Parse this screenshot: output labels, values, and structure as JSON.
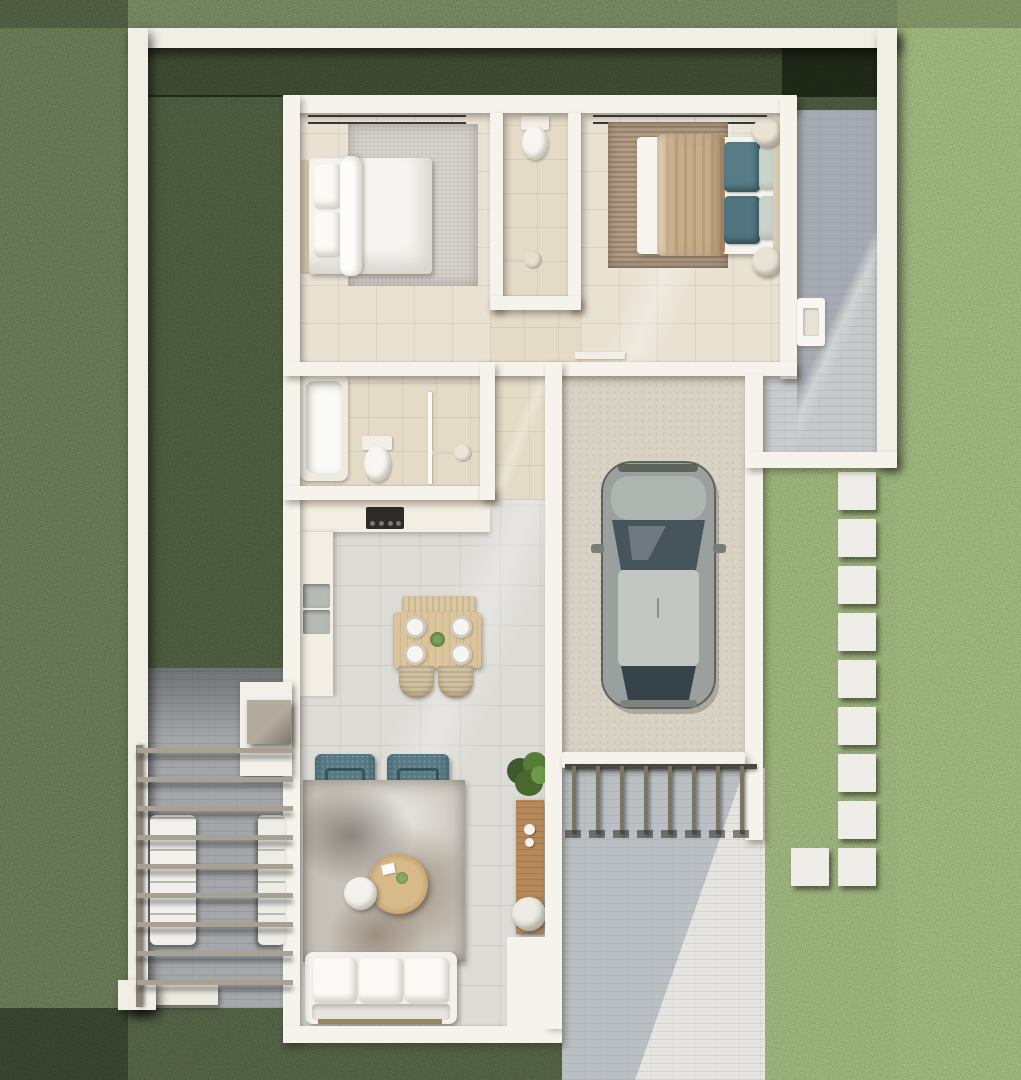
{
  "meta": {
    "view": "top-down-3d-render",
    "subject": "single-story residential floor plan with yard, garage, pergola patio and stepping-stone path"
  },
  "palette": {
    "grass_base": "#49662f",
    "wall_white": "#f6f3ec",
    "warm_tile": "#e9e2d3",
    "gray_tile": "#dcdbd6",
    "garage_floor": "#d8d2c4",
    "paver_gray": "#c6c8ca",
    "patio_paver": "#b4b8bb",
    "walkway": "#e5e4e0",
    "wood": "#c9a06c",
    "teal_accent": "#577a85",
    "tan_duvet": "#c7ad8c",
    "car_body": "#9aa09e",
    "car_roof": "#c3c7c2",
    "car_glass": "#46545b",
    "car_rear_glass": "#37434a",
    "plant_green": "#4c7034"
  },
  "counts": {
    "stepping_stones_column": 9,
    "stepping_stone_offset": 1,
    "pergola_beams": 9,
    "railing_posts": 8,
    "sofa_cushions": 3,
    "dining_plates": 4,
    "dining_chairs": 2,
    "living_armchairs": 2
  },
  "rooms": [
    {
      "id": "bedroom-1",
      "furniture": [
        "double-bed",
        "four-pillows",
        "white-throw",
        "nightstand-lamp-top",
        "nightstand-lamp-bottom",
        "gray-area-rug",
        "white-dresser",
        "curtain-rail"
      ]
    },
    {
      "id": "shared-bathroom",
      "furniture": [
        "toilet",
        "vanity-sink",
        "shower-head"
      ]
    },
    {
      "id": "bedroom-2",
      "furniture": [
        "double-bed",
        "tan-duvet",
        "teal-pillows",
        "striped-rug",
        "round-pouf-top",
        "round-pouf-bottom",
        "white-dresser",
        "wall-shelf",
        "curtain-rail"
      ]
    },
    {
      "id": "main-bathroom",
      "furniture": [
        "bathtub",
        "vanity-sink",
        "toilet",
        "glass-shower"
      ]
    },
    {
      "id": "hallway",
      "furniture": []
    },
    {
      "id": "kitchen-dining",
      "furniture": [
        "counter-run-top",
        "cooktop",
        "counter-run-left",
        "double-sink",
        "dining-bench",
        "dining-table",
        "plates",
        "wicker-chairs"
      ]
    },
    {
      "id": "living-room",
      "furniture": [
        "teal-armchair-left",
        "teal-armchair-right",
        "distressed-rug",
        "round-wood-coffee-table",
        "white-side-table",
        "three-seat-sofa",
        "potted-plant",
        "wood-console",
        "white-pouf"
      ]
    },
    {
      "id": "garage",
      "furniture": [
        "parked-car"
      ]
    }
  ],
  "outdoor": {
    "areas": [
      "perimeter-wall",
      "shaded-yard",
      "left-patio-with-pergola",
      "outdoor-lounge-sofas",
      "entry-step-with-planter-cube",
      "side-paved-yard",
      "utility-sink-niche",
      "stepping-stone-path",
      "driveway-walkway",
      "railing-gate"
    ]
  }
}
